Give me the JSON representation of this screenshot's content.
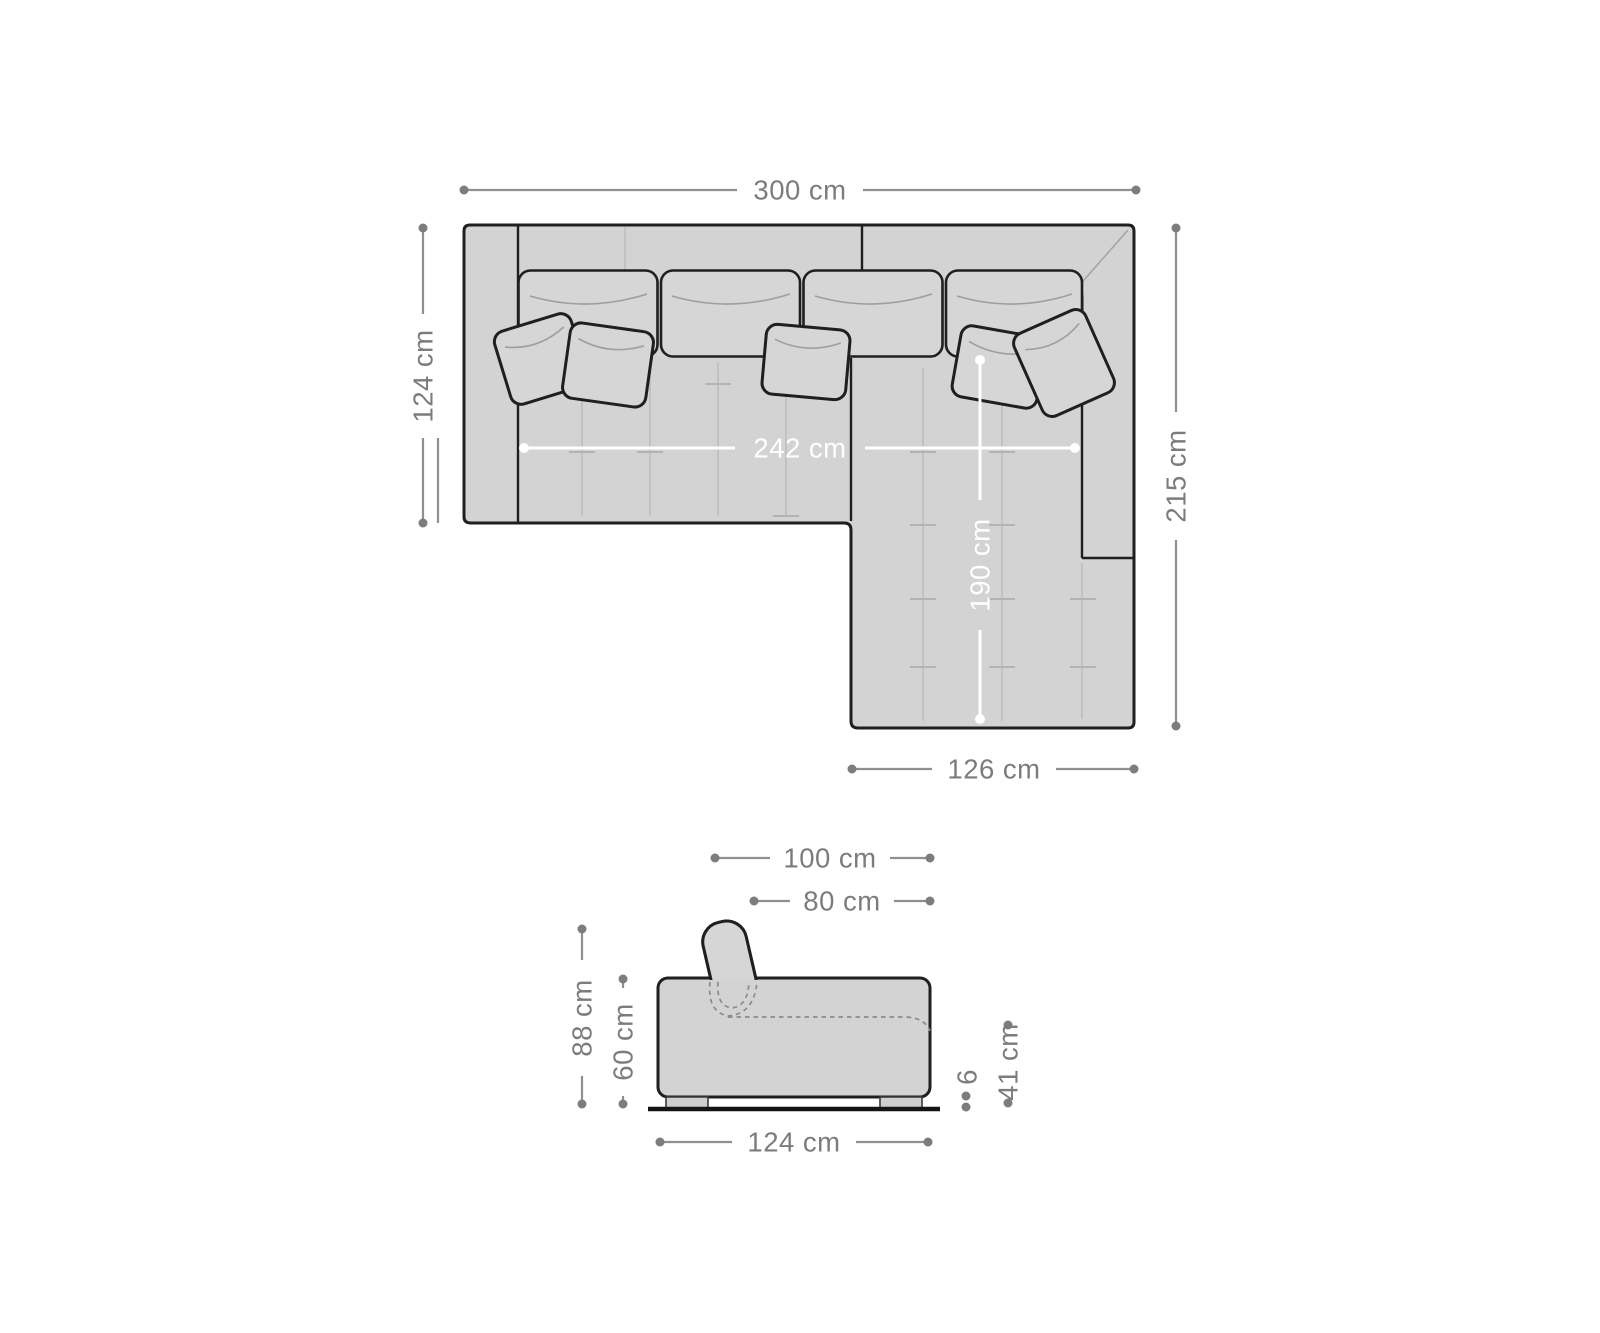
{
  "diagram": {
    "type": "sofa-dimension-diagram",
    "units": "cm",
    "colors": {
      "background": "#ffffff",
      "sofa_fill": "#d3d3d3",
      "cushion_fill": "#d6d6d6",
      "outline": "#1f1f1f",
      "dimension_gray": "#7c7c7c",
      "dimension_white": "#ffffff"
    },
    "top_view": {
      "name": "sofa-top-view",
      "dims": {
        "overall_width": "300 cm",
        "left_depth": "124 cm",
        "overall_depth": "215 cm",
        "inner_seat_width": "242 cm",
        "chaise_inner_length": "190 cm",
        "chaise_width": "126 cm"
      }
    },
    "side_view": {
      "name": "sofa-side-view",
      "dims": {
        "depth_with_back_cushion": "100 cm",
        "seat_depth": "80 cm",
        "total_height": "88 cm",
        "body_height": "60 cm",
        "base_depth": "124 cm",
        "foot_height": "6",
        "seat_height": "41 cm"
      }
    }
  }
}
